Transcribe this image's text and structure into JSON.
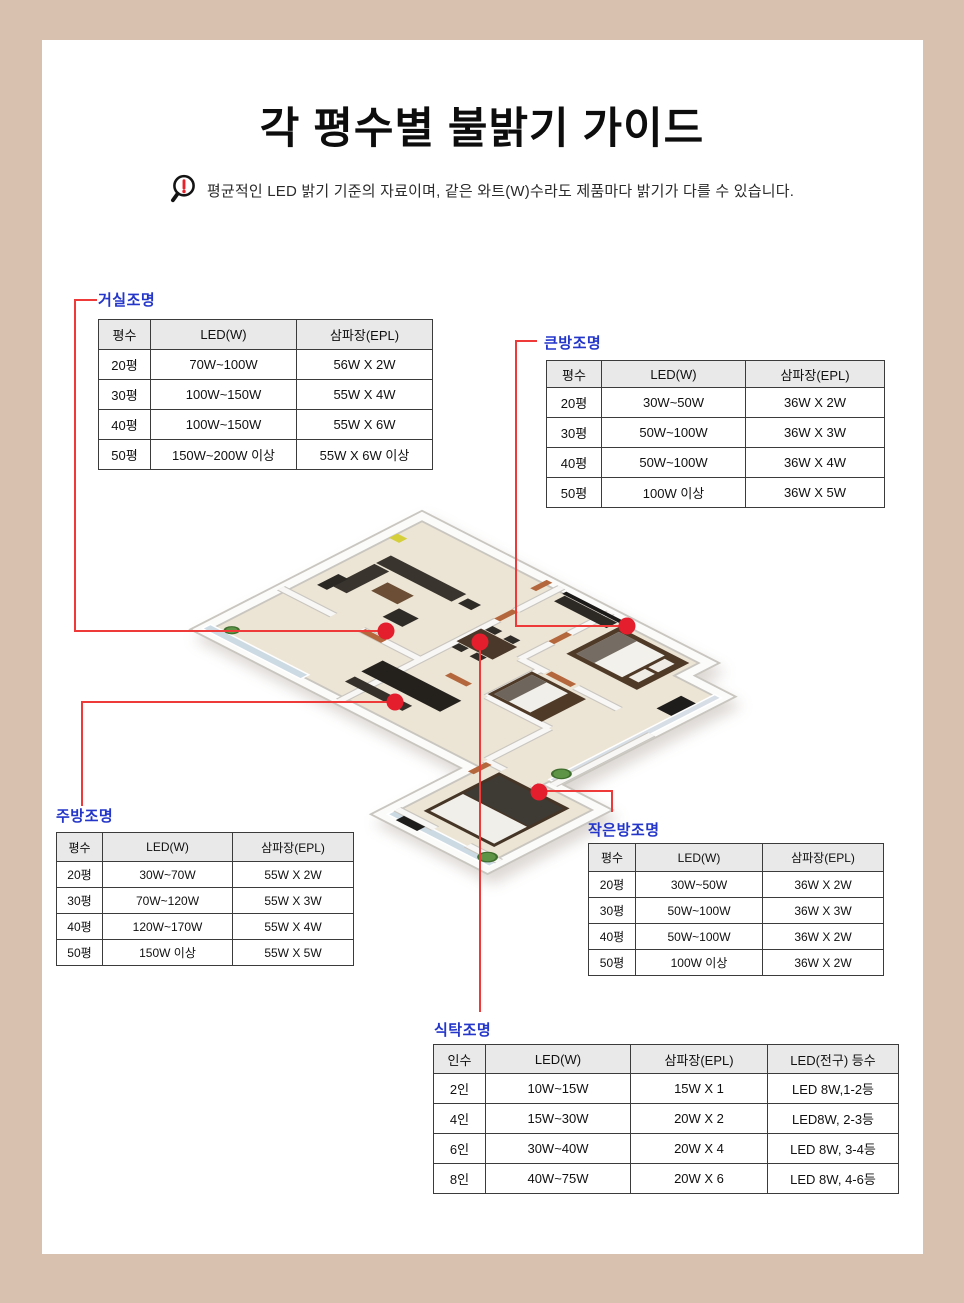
{
  "page": {
    "title": "각 평수별 불밝기 가이드",
    "disclaimer": "평균적인 LED 밝기 기준의 자료이며, 같은 와트(W)수라도 제품마다 밝기가 다를 수 있습니다."
  },
  "colors": {
    "page_bg": "#d8c1af",
    "card_bg": "#ffffff",
    "title": "#0d0d0d",
    "label_blue": "#2336c9",
    "line_red": "#ef3a3a",
    "dot_red": "#e41e2d",
    "table_border": "#3b3b3b",
    "header_bg": "#e9e9e9"
  },
  "tables": {
    "living": {
      "label": "거실조명",
      "headers": [
        "평수",
        "LED(W)",
        "삼파장(EPL)"
      ],
      "rows": [
        [
          "20평",
          "70W~100W",
          "56W X 2W"
        ],
        [
          "30평",
          "100W~150W",
          "55W X 4W"
        ],
        [
          "40평",
          "100W~150W",
          "55W X 6W"
        ],
        [
          "50평",
          "150W~200W 이상",
          "55W X 6W 이상"
        ]
      ]
    },
    "master": {
      "label": "큰방조명",
      "headers": [
        "평수",
        "LED(W)",
        "삼파장(EPL)"
      ],
      "rows": [
        [
          "20평",
          "30W~50W",
          "36W X 2W"
        ],
        [
          "30평",
          "50W~100W",
          "36W X 3W"
        ],
        [
          "40평",
          "50W~100W",
          "36W X 4W"
        ],
        [
          "50평",
          "100W 이상",
          "36W X 5W"
        ]
      ]
    },
    "kitchen": {
      "label": "주방조명",
      "headers": [
        "평수",
        "LED(W)",
        "삼파장(EPL)"
      ],
      "rows": [
        [
          "20평",
          "30W~70W",
          "55W X 2W"
        ],
        [
          "30평",
          "70W~120W",
          "55W X 3W"
        ],
        [
          "40평",
          "120W~170W",
          "55W X 4W"
        ],
        [
          "50평",
          "150W 이상",
          "55W X 5W"
        ]
      ]
    },
    "small": {
      "label": "작은방조명",
      "headers": [
        "평수",
        "LED(W)",
        "삼파장(EPL)"
      ],
      "rows": [
        [
          "20평",
          "30W~50W",
          "36W X 2W"
        ],
        [
          "30평",
          "50W~100W",
          "36W X 3W"
        ],
        [
          "40평",
          "50W~100W",
          "36W X 2W"
        ],
        [
          "50평",
          "100W 이상",
          "36W X 2W"
        ]
      ]
    },
    "dining": {
      "label": "식탁조명",
      "headers": [
        "인수",
        "LED(W)",
        "삼파장(EPL)",
        "LED(전구) 등수"
      ],
      "rows": [
        [
          "2인",
          "10W~15W",
          "15W X 1",
          "LED 8W,1-2등"
        ],
        [
          "4인",
          "15W~30W",
          "20W X 2",
          "LED8W, 2-3등"
        ],
        [
          "6인",
          "30W~40W",
          "20W X 4",
          "LED 8W, 3-4등"
        ],
        [
          "8인",
          "40W~75W",
          "20W X 6",
          "LED 8W, 4-6등"
        ]
      ]
    }
  }
}
